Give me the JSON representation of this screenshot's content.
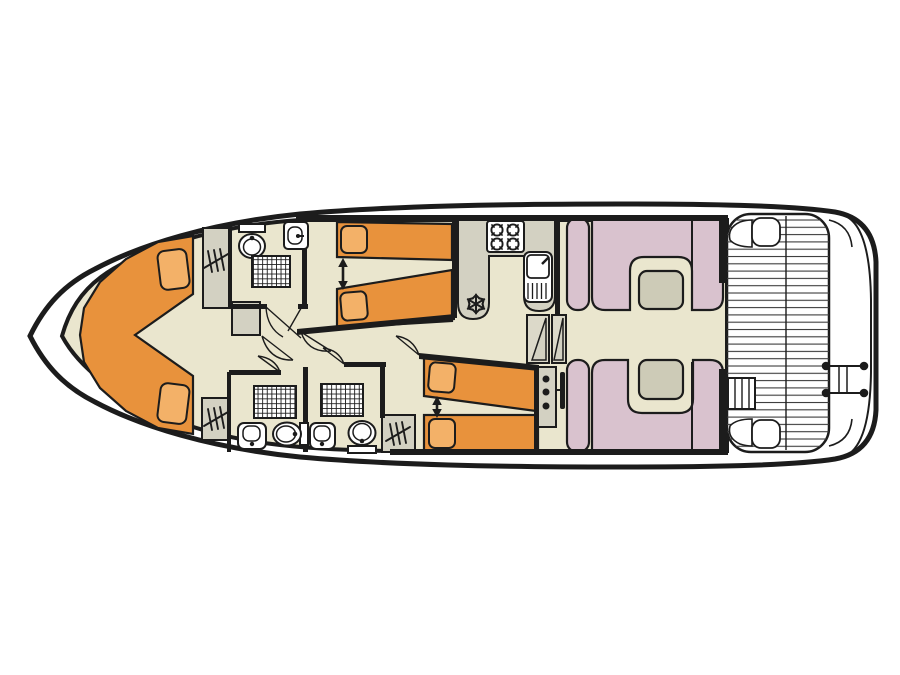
{
  "diagram": {
    "type": "houseboat-floor-plan",
    "description": "Top-down deck plan of a canal cruiser houseboat, bow to the left, stern deck to the right",
    "orientation": {
      "bow": "left",
      "stern": "right"
    }
  },
  "colors": {
    "background": "#FFFFFF",
    "hull": "#FFFFFF",
    "outline": "#1C1C1C",
    "floor": "#EAE6CE",
    "bed": "#E8923C",
    "pillow": "#F3B168",
    "seating": "#D9C2CE",
    "table": "#CDCBB7",
    "cabinet": "#D3D1C2",
    "stairs": "#DCD9C9",
    "fixture": "#FFFFFF",
    "plank_line": "#3B3B3B"
  },
  "rooms": [
    {
      "id": "bow-v-berth-cabin",
      "label": "Bow cabin with V-shaped double berth"
    },
    {
      "id": "forward-bathroom",
      "label": "Forward bathroom with shower, toilet and washbasin"
    },
    {
      "id": "forward-twin-cabin",
      "label": "Forward twin cabin with sliding single beds"
    },
    {
      "id": "aft-bathroom-1",
      "label": "Aft bathroom 1 with shower, toilet and washbasin"
    },
    {
      "id": "aft-bathroom-2",
      "label": "Aft bathroom 2 with shower, toilet and washbasin"
    },
    {
      "id": "aft-twin-cabin",
      "label": "Aft twin cabin with sliding single beds"
    },
    {
      "id": "galley",
      "label": "Galley with stove, sink and fridge"
    },
    {
      "id": "helm-station",
      "label": "Inside helm station with wheel"
    },
    {
      "id": "saloon",
      "label": "Saloon with two dinette booths and tables"
    },
    {
      "id": "rear-deck",
      "label": "Planked rear deck with corner seats and ladder"
    },
    {
      "id": "swim-platform",
      "label": "Stern platform with boarding rails"
    }
  ],
  "features": {
    "v_berth_double_bed": 1,
    "single_beds": 4,
    "bed_slide_arrows": 2,
    "pillows": 6,
    "toilets": 3,
    "showers": 3,
    "washbasins": 3,
    "wardrobes": 3,
    "stove_burners": 4,
    "galley_sink": 1,
    "fridge_snowflake_icon": 1,
    "companionway_steps": 2,
    "helm_instrument_dots": 3,
    "steering_wheel": 1,
    "dinette_tables": 2,
    "deck_ladder": 1,
    "stern_rails": 2,
    "door_swings": 7
  }
}
